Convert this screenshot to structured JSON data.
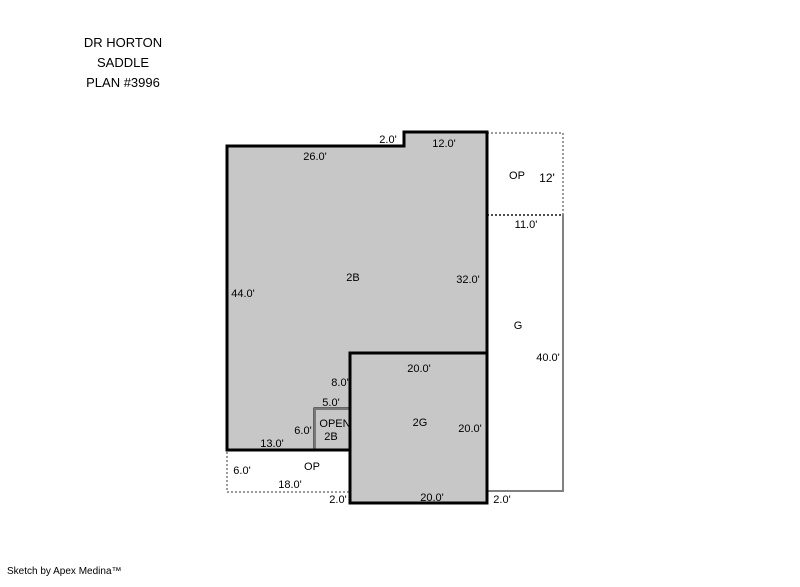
{
  "title": {
    "line1": "DR HORTON",
    "line2": "SADDLE",
    "line3": "PLAN #3996"
  },
  "footer": {
    "credit": "Sketch by Apex Medina™"
  },
  "colors": {
    "area_fill": "#C7C7C7",
    "outline": "#000000",
    "garage_outline": "#808080",
    "dotted_border": "#9A9A9A",
    "open_box_border": "#787878"
  },
  "plan": {
    "areas": {
      "two_story": "2B",
      "attached_garage": "2G",
      "garage": "G",
      "open_patio_upper": "OP",
      "open_patio_lower": "OP",
      "open_below_line1": "OPEN",
      "open_below_line2": "2B"
    },
    "dims": {
      "d26": "26.0'",
      "d2_top": "2.0'",
      "d12_top": "12.0'",
      "d12_right": "12'",
      "d11": "11.0'",
      "d32": "32.0'",
      "d44": "44.0'",
      "d40": "40.0'",
      "d20_top": "20.0'",
      "d8": "8.0'",
      "d5": "5.0'",
      "d6_open": "6.0'",
      "d20_right": "20.0'",
      "d13": "13.0'",
      "d6_op": "6.0'",
      "d18": "18.0'",
      "d2_left": "2.0'",
      "d20_bottom": "20.0'",
      "d2_right": "2.0'"
    }
  }
}
